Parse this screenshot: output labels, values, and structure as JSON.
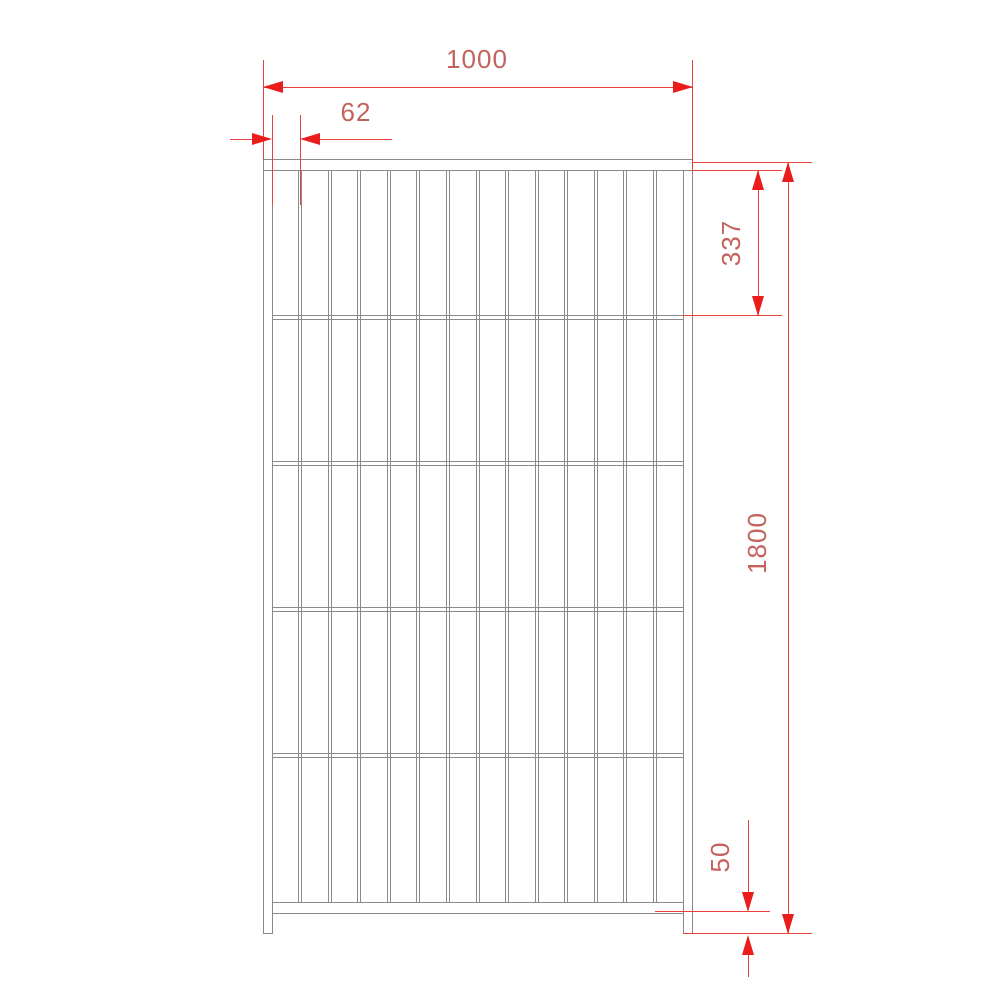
{
  "drawing": {
    "type": "technical-drawing",
    "subject": "fence-panel-front-view",
    "dimensions": {
      "width": {
        "label": "1000"
      },
      "bar_spacing": {
        "label": "62"
      },
      "top_section_height": {
        "label": "337"
      },
      "total_height": {
        "label": "1800"
      },
      "bottom_clearance": {
        "label": "50"
      }
    },
    "figure": {
      "vertical_bar_count": 13,
      "intermediate_rail_count": 4
    },
    "colors": {
      "background": "#ffffff",
      "line_grey": "#8a8a8a",
      "dimension_red": "#e8403a",
      "arrow_red": "#ea1c1c",
      "text_red": "#c4625e"
    }
  }
}
